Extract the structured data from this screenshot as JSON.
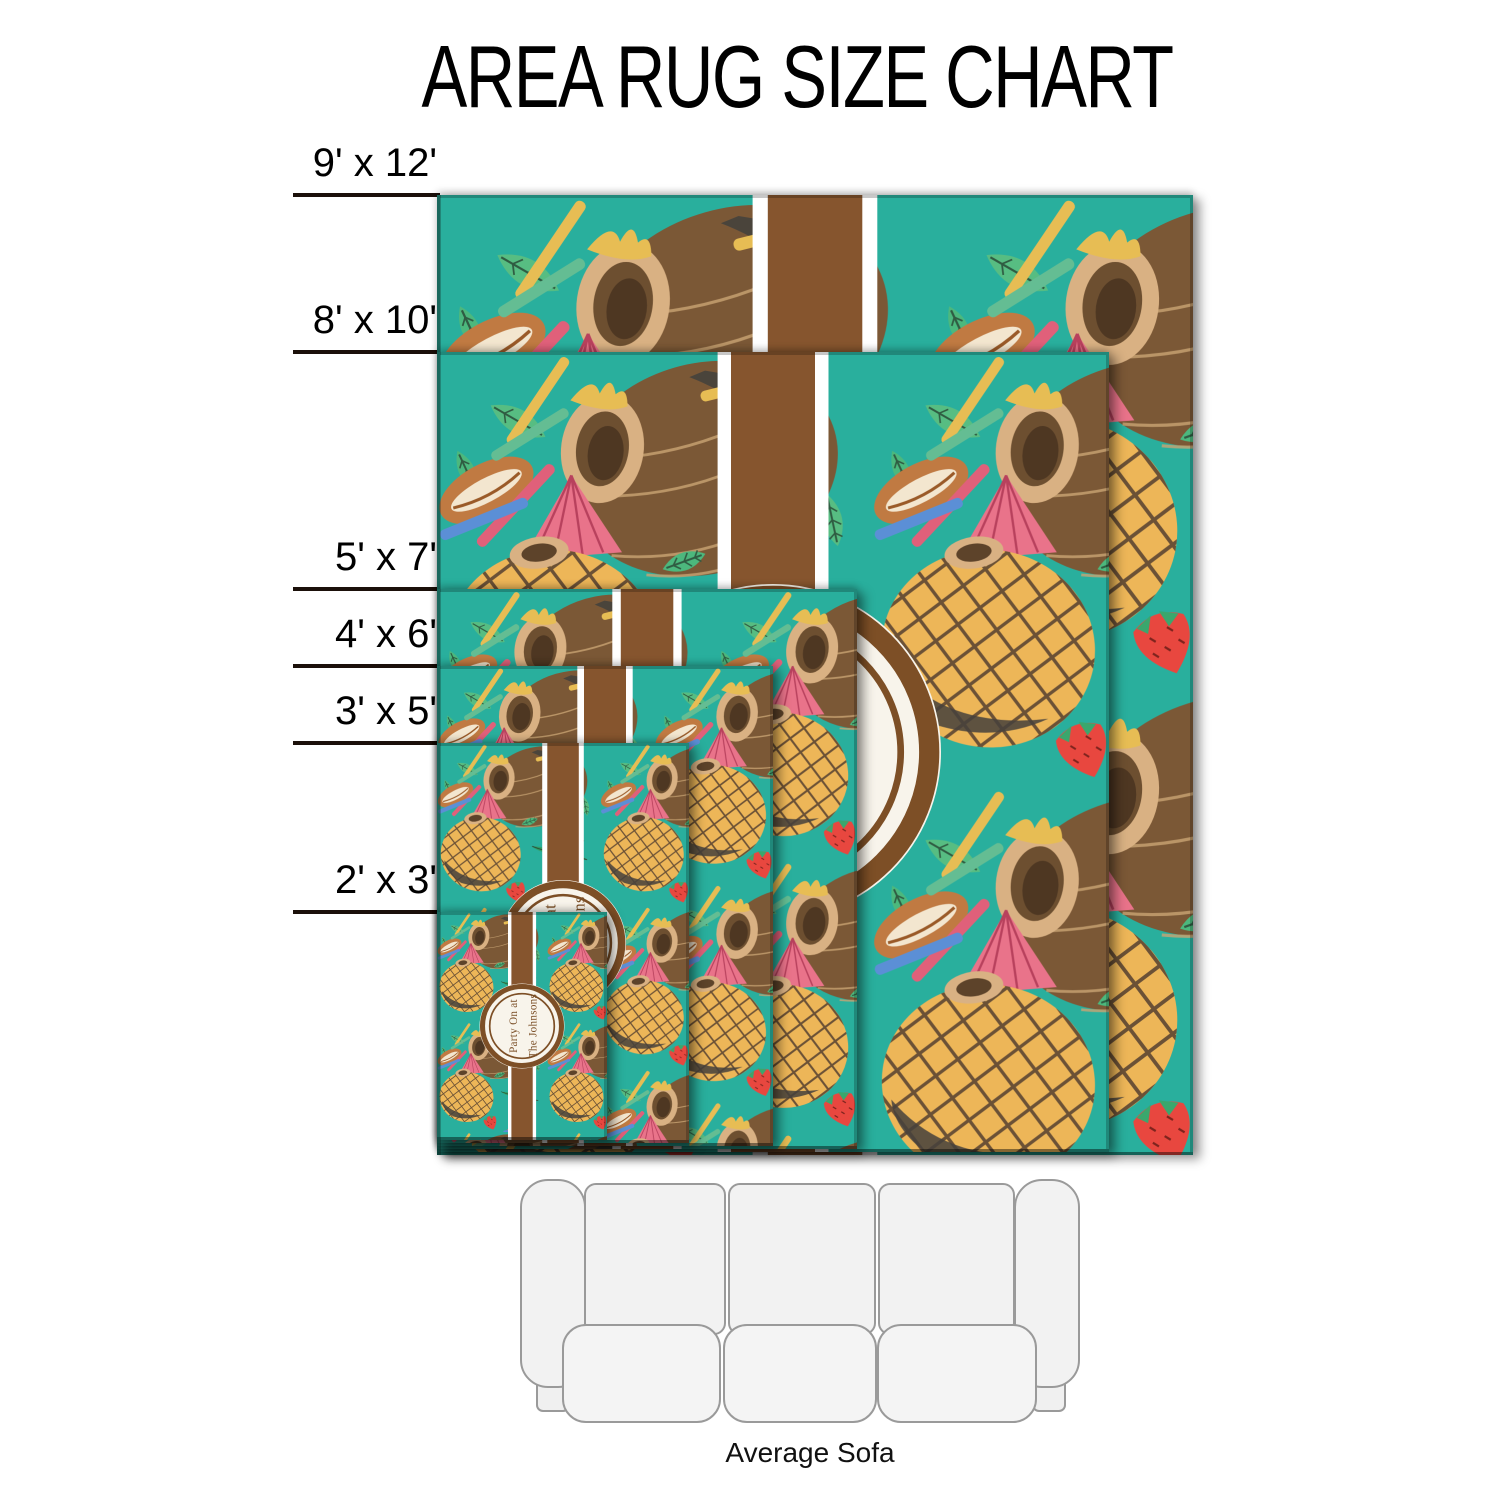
{
  "title": "AREA RUG SIZE CHART",
  "rugs": [
    {
      "label": "9' x 12'",
      "width_ft": 9,
      "length_ft": 12
    },
    {
      "label": "8' x 10'",
      "width_ft": 8,
      "length_ft": 10
    },
    {
      "label": "5' x 7'",
      "width_ft": 5,
      "length_ft": 7
    },
    {
      "label": "4' x 6'",
      "width_ft": 4,
      "length_ft": 6
    },
    {
      "label": "3' x 5'",
      "width_ft": 3,
      "length_ft": 5
    },
    {
      "label": "2' x 3'",
      "width_ft": 2,
      "length_ft": 3
    }
  ],
  "rug_design": {
    "theme": "coconut-drinks-tropical",
    "monogram_line1": "Party On at",
    "monogram_line2": "The Johnsons",
    "colors": {
      "background": "#29AF9D",
      "ribbon_brown": "#86552E",
      "ribbon_white": "#FFFFFF",
      "circle_fill": "#F8F4EB",
      "circle_ring": "#7D4F26",
      "monogram_text": "#7A4E26",
      "coconut": "#7B5836",
      "coconut_dark": "#45413C",
      "coconut_rim": "#D9B183",
      "coconut_rim_inner": "#5D432A",
      "wicker": "#EDB658",
      "crosshatch": "#5D4631",
      "palm_green_dark": "#2F9E63",
      "palm_green_light": "#4CB87D",
      "leaf_green": "#57BD82",
      "leaf_vein": "#2F5C42",
      "straw_yellow": "#E7BD54",
      "straw_pink": "#E0607A",
      "straw_blue": "#5B8FD6",
      "straw_green": "#64BD93",
      "umbrella_pink": "#E9738A",
      "umbrella_rib": "#B8415D",
      "strawberry_red": "#E8473F",
      "strawberry_seed": "#7E231D",
      "pod_orange": "#C07A42",
      "pod_slit": "#F3E6CF"
    }
  },
  "sofa": {
    "caption": "Average Sofa"
  }
}
